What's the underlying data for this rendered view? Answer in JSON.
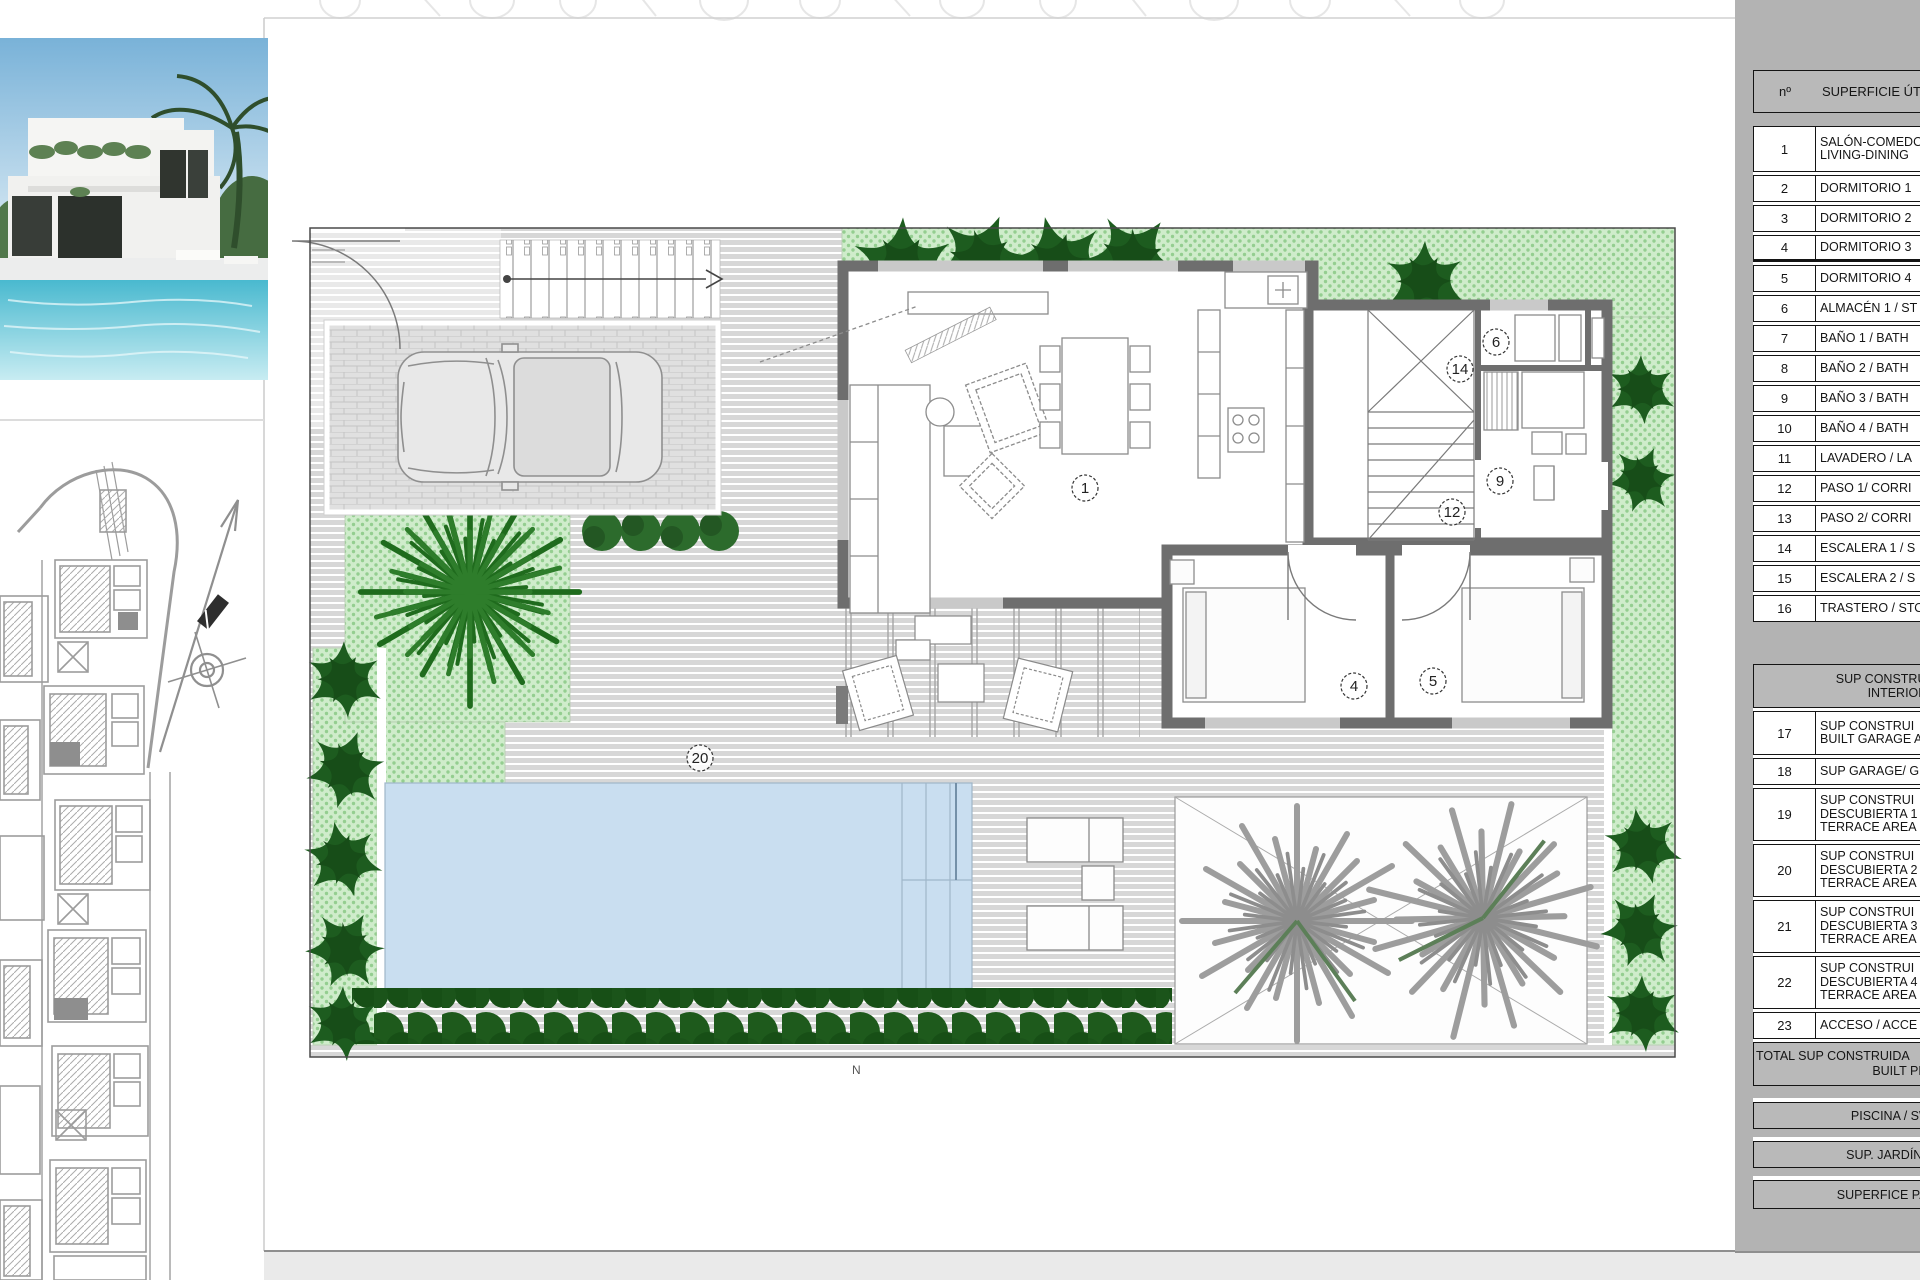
{
  "panel": {
    "header": {
      "num": "nº",
      "label": "SUPERFICIE ÚTIL"
    },
    "rows": [
      {
        "num": "1",
        "lines": [
          "SALÓN-COMEDO",
          "LIVING-DINING"
        ]
      },
      {
        "num": "2",
        "lines": [
          "DORMITORIO 1"
        ]
      },
      {
        "num": "3",
        "lines": [
          "DORMITORIO 2"
        ]
      },
      {
        "num": "4",
        "lines": [
          "DORMITORIO 3"
        ]
      },
      {
        "num": "5",
        "lines": [
          "DORMITORIO 4"
        ]
      },
      {
        "num": "6",
        "lines": [
          "ALMACÉN 1 / ST"
        ]
      },
      {
        "num": "7",
        "lines": [
          "BAÑO 1 / BATH"
        ]
      },
      {
        "num": "8",
        "lines": [
          "BAÑO 2 / BATH"
        ]
      },
      {
        "num": "9",
        "lines": [
          "BAÑO 3 / BATH"
        ]
      },
      {
        "num": "10",
        "lines": [
          "BAÑO 4 / BATH"
        ]
      },
      {
        "num": "11",
        "lines": [
          "LAVADERO / LA"
        ]
      },
      {
        "num": "12",
        "lines": [
          "PASO 1/ CORRI"
        ]
      },
      {
        "num": "13",
        "lines": [
          "PASO 2/ CORRI"
        ]
      },
      {
        "num": "14",
        "lines": [
          "ESCALERA 1 / S"
        ]
      },
      {
        "num": "15",
        "lines": [
          "ESCALERA 2 / S"
        ]
      },
      {
        "num": "16",
        "lines": [
          "TRASTERO / STO"
        ]
      }
    ],
    "section": {
      "lines": [
        "SUP CONSTRUIDA INT",
        "INTERIOR A"
      ]
    },
    "rows2": [
      {
        "num": "17",
        "lines": [
          "SUP CONSTRUI",
          "BUILT GARAGE A"
        ]
      },
      {
        "num": "18",
        "lines": [
          "SUP GARAGE/ G"
        ]
      },
      {
        "num": "19",
        "lines": [
          "SUP CONSTRUI",
          "DESCUBIERTA 1",
          "TERRACE AREA"
        ]
      },
      {
        "num": "20",
        "lines": [
          "SUP CONSTRUI",
          "DESCUBIERTA 2",
          "TERRACE AREA"
        ]
      },
      {
        "num": "21",
        "lines": [
          "SUP CONSTRUI",
          "DESCUBIERTA 3",
          "TERRACE AREA"
        ]
      },
      {
        "num": "22",
        "lines": [
          "SUP CONSTRUI",
          "DESCUBIERTA 4",
          "TERRACE AREA"
        ]
      },
      {
        "num": "23",
        "lines": [
          "ACCESO / ACCE"
        ]
      }
    ],
    "total": {
      "lines": [
        "TOTAL SUP CONSTRUIDA",
        "BUILT PRIVATE"
      ]
    },
    "footers": [
      "PISCINA / SWIMM",
      "SUP. JARDÍN / GAR",
      "SUPERFICE PARCELA"
    ]
  },
  "plan": {
    "labels": [
      "1",
      "4",
      "5",
      "6",
      "9",
      "12",
      "14",
      "20"
    ],
    "footer_mark": "N"
  },
  "colors": {
    "panel_gray": "#b3b3b3",
    "garden_green": "#cfeccb",
    "bush_green": "#1d5c1f",
    "teal_accent": "#8fd8cc",
    "pool_blue": "#c9def0",
    "deck_gray": "#d7d7d7",
    "wall_gray": "#6e6e6e"
  }
}
